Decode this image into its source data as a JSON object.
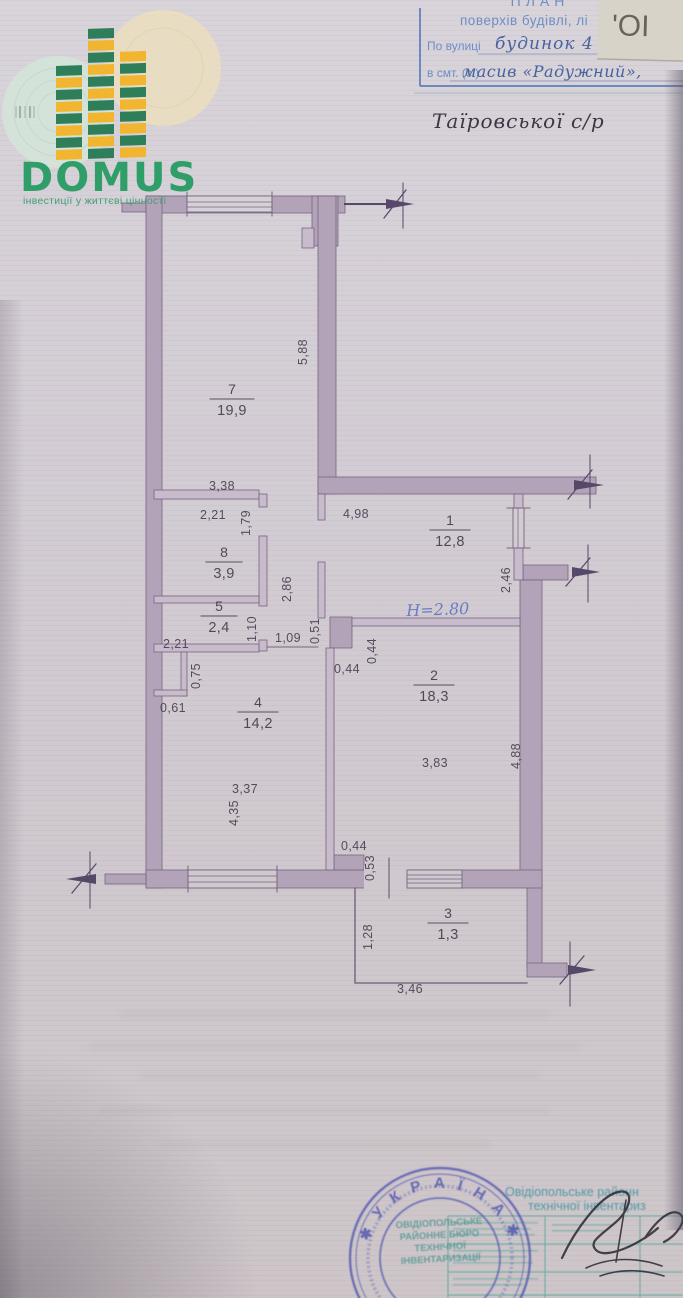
{
  "logo": {
    "brand": "DOMUS",
    "tagline": "інвестиції у життєві цінності"
  },
  "form": {
    "title": "ПЛАН",
    "subtitle": "поверхів будівлі, лі",
    "street_label": "По вулиці",
    "street_value": "будинок 4",
    "settlement_label": "в смт. (с.)",
    "settlement_value": "масив «Радужний»,",
    "council": "Таїровської с/р",
    "corner_mark": "'ОІ"
  },
  "plan": {
    "height_note": "Н=2.80",
    "rooms": [
      {
        "number": "7",
        "area": "19,9"
      },
      {
        "number": "8",
        "area": "3,9"
      },
      {
        "number": "5",
        "area": "2,4"
      },
      {
        "number": "1",
        "area": "12,8"
      },
      {
        "number": "2",
        "area": "18,3"
      },
      {
        "number": "4",
        "area": "14,2"
      },
      {
        "number": "3",
        "area": "1,3"
      }
    ],
    "dims": {
      "room7_h": "5,88",
      "room7_w": "3,38",
      "room8_w": "2,21",
      "room8_h": "1,79",
      "room1_w": "4,98",
      "room1_side": "2,46",
      "corridor_h": "2,86",
      "room5_h": "1,10",
      "room5_w": "2,21",
      "hall_w": "1,09",
      "step_h": "0,51",
      "pillar_h": "0,44",
      "pillar_w": "0,44",
      "room2_w": "3,83",
      "room2_h": "4,88",
      "closet_h": "0,75",
      "closet_w": "0,61",
      "room4_w": "3,37",
      "room4_h": "4,35",
      "balcony_door_w": "0,44",
      "balcony_door_h": "0,53",
      "balcony_h": "1,28",
      "balcony_w": "3,46"
    }
  },
  "stamp": {
    "country_arc": "✱  У К Р А Ї Н А  ✱",
    "center_line1": "ОВІДІОПОЛЬСЬКЕ",
    "center_line2": "РАЙОННЕ БЮРО",
    "center_line3": "ТЕХНІЧНОЇ",
    "center_line4": "ІНВЕНТАРИЗАЦІЇ"
  },
  "footer_table": {
    "header_line1": "Овідіопольське районн",
    "header_line2": "технічної інвентариз"
  }
}
